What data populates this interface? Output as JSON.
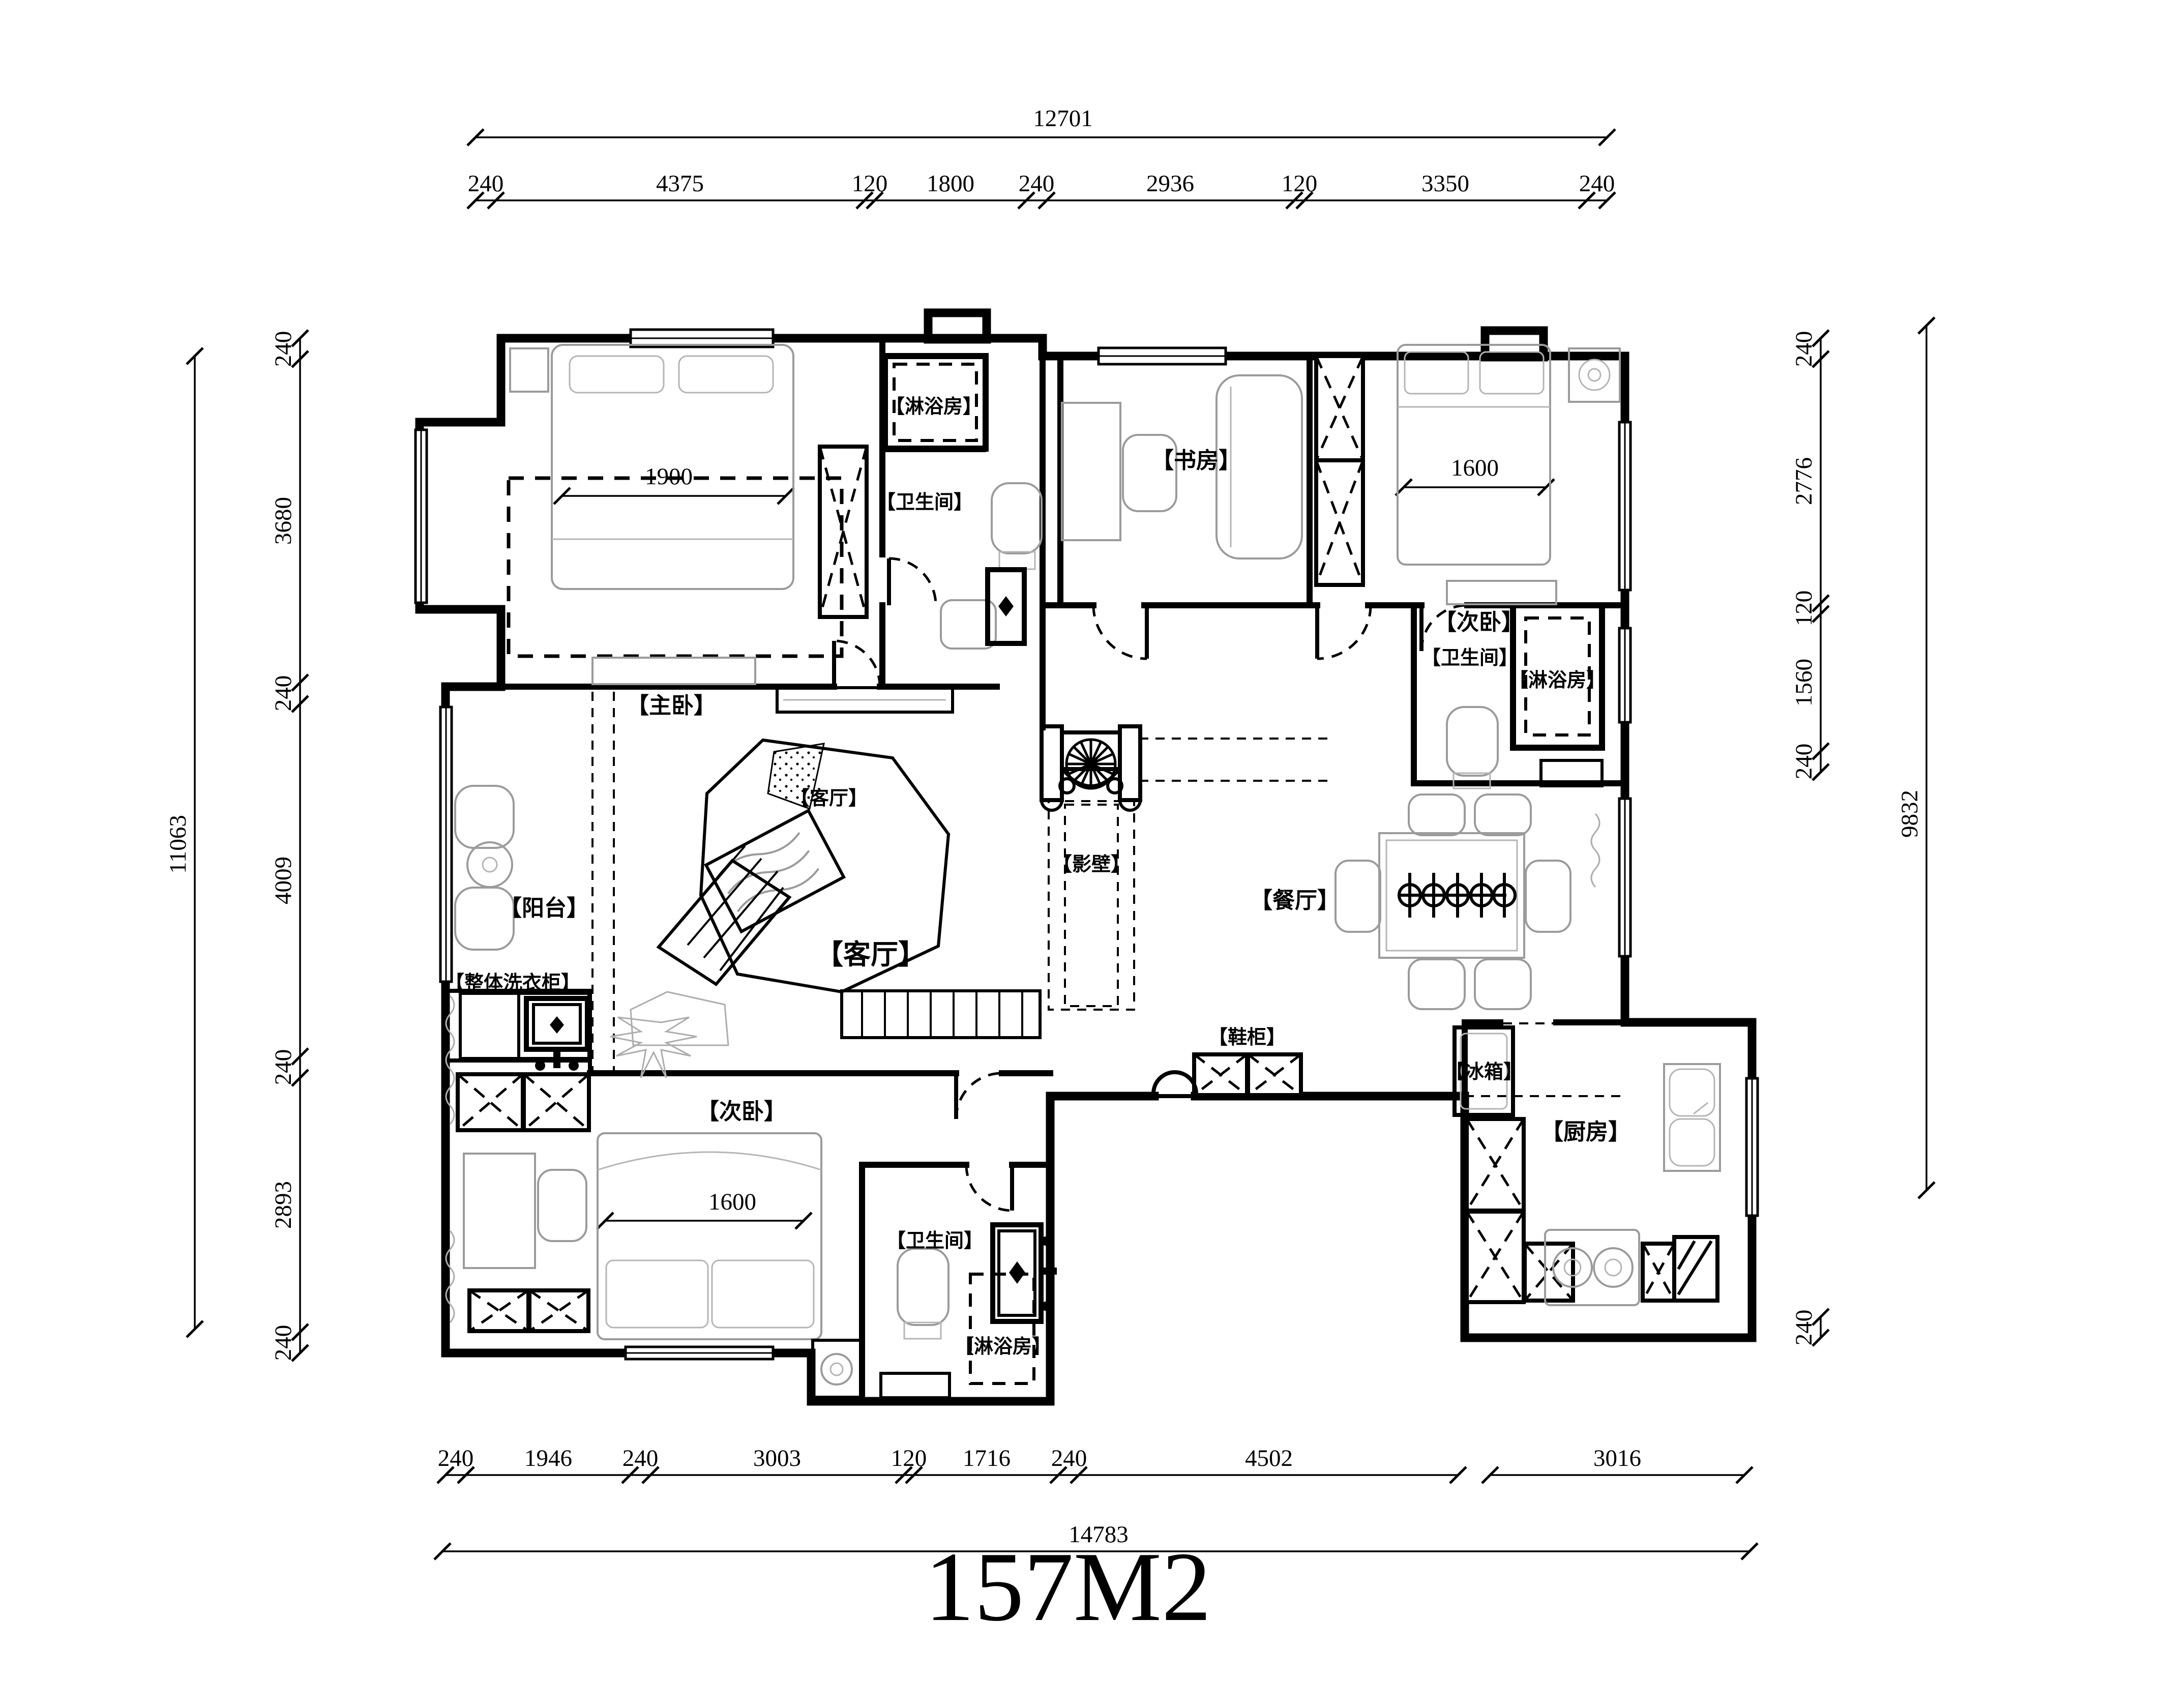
{
  "title": "157M2",
  "rooms": {
    "master_bedroom": "【主卧】",
    "shower_top": "【淋浴房】",
    "bath_top": "【卫生间】",
    "study": "【书房】",
    "bedroom2_top": "【次卧】",
    "bath_right": "【卫生间】",
    "shower_right": "【淋浴房】",
    "living_tv": "【客厅】",
    "screen_wall": "【影壁】",
    "balcony": "【阳台】",
    "living_main": "【客厅】",
    "dining": "【餐厅】",
    "shoe_cabinet": "【鞋柜】",
    "laundry": "【整体洗衣柜】",
    "fridge": "【冰箱】",
    "kitchen": "【厨房】",
    "bedroom2_bottom": "【次卧】",
    "bath_bottom": "【卫生间】",
    "shower_bottom": "【淋浴房】"
  },
  "dims": {
    "top_total": "12701",
    "top": [
      "240",
      "4375",
      "120",
      "1800",
      "240",
      "2936",
      "120",
      "3350",
      "240"
    ],
    "bottom": [
      "240",
      "1946",
      "240",
      "3003",
      "120",
      "1716",
      "240",
      "4502",
      "3016"
    ],
    "bottom_total": "14783",
    "left": [
      "240",
      "3680",
      "240",
      "4009",
      "240",
      "2893",
      "240"
    ],
    "left_total": "11063",
    "right": [
      "240",
      "2776",
      "120",
      "1560",
      "240"
    ],
    "right_total": "9832",
    "right_kitchen": "240",
    "master_bed": "1900",
    "bed2_top": "1600",
    "bed2_bottom": "1600"
  }
}
